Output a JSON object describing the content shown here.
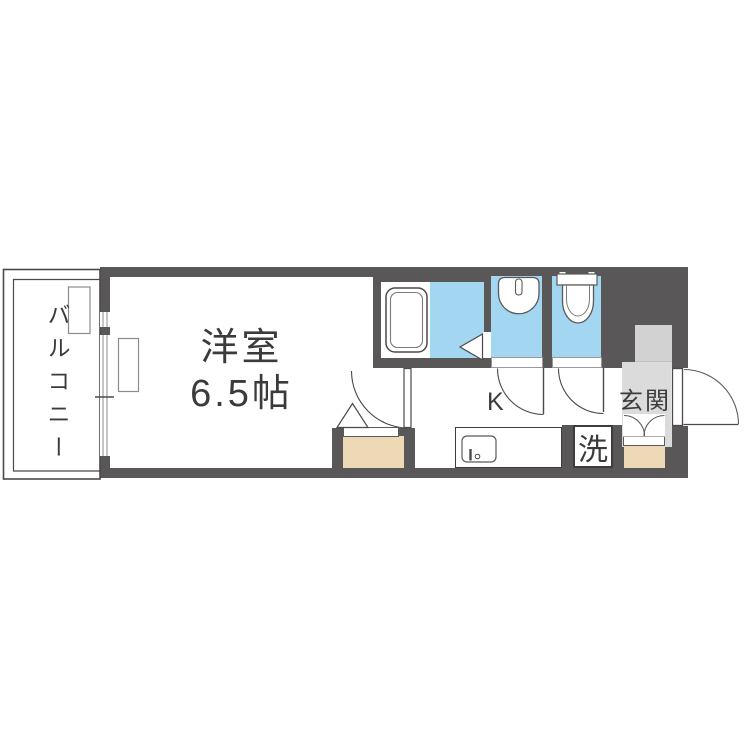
{
  "plan": {
    "balcony": {
      "label": "バルコニー"
    },
    "western_room": {
      "name": "洋室",
      "size": "6.5帖"
    },
    "kitchen": {
      "label": "K"
    },
    "laundry": {
      "label": "洗"
    },
    "entrance": {
      "label": "玄関"
    }
  },
  "colors": {
    "wall": "#595757",
    "wet_blue": "#a3d6f0",
    "storage_tan": "#edd9b5",
    "entry_gray": "#dcdbdb",
    "recess_gray": "#d3d2d2",
    "line_dark": "#4b4949",
    "text": "#3b3b3b"
  },
  "icons": [
    "bathtub-icon",
    "wash-basin-icon",
    "toilet-icon",
    "kitchen-sink-icon",
    "bath-door-icon",
    "room-door-swing",
    "washroom-door-swing",
    "toilet-door-swing",
    "entrance-door-swing",
    "shoe-cabinet-doors",
    "ac-unit-balcony-icon",
    "ac-unit-room-icon",
    "window-lines",
    "balcony-outline"
  ]
}
